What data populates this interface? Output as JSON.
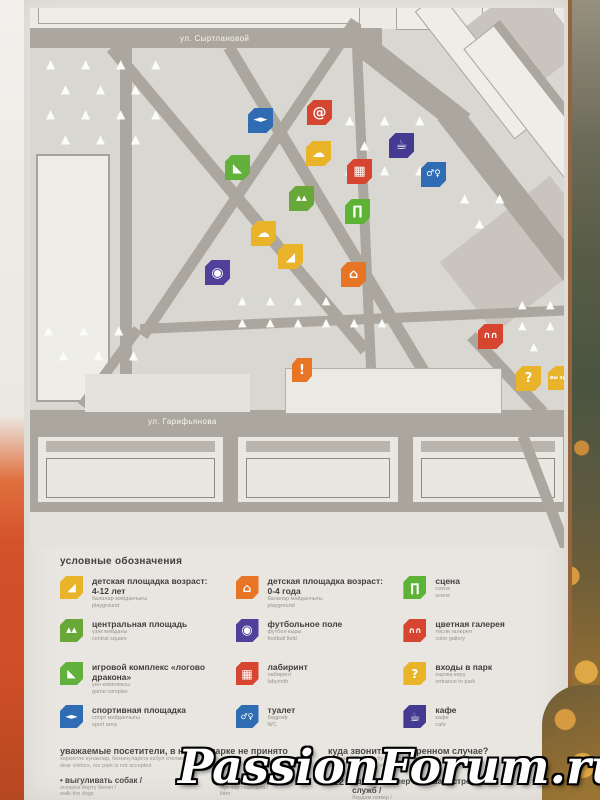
{
  "watermark": "PassionForum.ru",
  "map": {
    "street1": "ул. Сыртлановой",
    "street2": "ул. Гарифьянова",
    "icons": [
      {
        "name": "sport-area-icon",
        "glyph": "◄►",
        "color": "#2f6cb3",
        "x": 218,
        "y": 100,
        "fs": 9
      },
      {
        "name": "internet-point-icon",
        "glyph": "@",
        "color": "#d6452f",
        "x": 277,
        "y": 92,
        "fs": 14
      },
      {
        "name": "cafe-icon",
        "glyph": "☕",
        "color": "#453a92",
        "x": 359,
        "y": 125,
        "fs": 13
      },
      {
        "name": "art-object-icon",
        "glyph": "☁",
        "color": "#e9b32a",
        "x": 276,
        "y": 133,
        "fs": 13
      },
      {
        "name": "game-complex-icon",
        "glyph": "◣",
        "color": "#62b13c",
        "x": 195,
        "y": 147,
        "fs": 12
      },
      {
        "name": "labyrinth-icon",
        "glyph": "▦",
        "color": "#d6452f",
        "x": 317,
        "y": 151,
        "fs": 13
      },
      {
        "name": "wc-icon",
        "glyph": "♂♀",
        "color": "#2f6cb3",
        "x": 391,
        "y": 154,
        "fs": 9
      },
      {
        "name": "central-square-icon",
        "glyph": "▲▲",
        "color": "#68a839",
        "x": 259,
        "y": 178,
        "fs": 7
      },
      {
        "name": "scene-icon",
        "glyph": "∏",
        "color": "#5cb336",
        "x": 315,
        "y": 191,
        "fs": 13
      },
      {
        "name": "art-object-icon",
        "glyph": "☁",
        "color": "#e9b32a",
        "x": 221,
        "y": 213,
        "fs": 13
      },
      {
        "name": "playground-4-12-icon",
        "glyph": "◢",
        "color": "#e9b32a",
        "x": 248,
        "y": 236,
        "fs": 12
      },
      {
        "name": "football-field-icon",
        "glyph": "◉",
        "color": "#50409a",
        "x": 175,
        "y": 252,
        "fs": 14
      },
      {
        "name": "playground-0-4-icon",
        "glyph": "⌂",
        "color": "#e87425",
        "x": 311,
        "y": 254,
        "fs": 13
      },
      {
        "name": "color-gallery-icon",
        "glyph": "∩∩",
        "color": "#d6452f",
        "x": 448,
        "y": 316,
        "fs": 9
      },
      {
        "name": "attention-icon",
        "glyph": "!",
        "color": "#e87425",
        "x": 262,
        "y": 350,
        "fs": 13,
        "w": 20,
        "h": 24
      },
      {
        "name": "park-entrance-icon",
        "glyph": "?",
        "color": "#e9b32a",
        "x": 486,
        "y": 358,
        "fs": 13
      },
      {
        "name": "you-are-here-icon",
        "glyph": "вы здесь",
        "color": "#e9b32a",
        "x": 518,
        "y": 358,
        "fs": 5,
        "w": 30,
        "h": 24
      }
    ]
  },
  "legend": {
    "title": "условные обозначения",
    "columns": [
      [
        {
          "icon": "playground-4-12-icon",
          "glyph": "◢",
          "color": "#e9b32a",
          "fs": 11,
          "title": "детская площадка возраст: 4-12 лет",
          "sub1": "балалар мәйданчыгы",
          "sub2": "playground"
        },
        {
          "icon": "central-square-icon",
          "glyph": "▲▲",
          "color": "#68a839",
          "fs": 7,
          "title": "центральная площадь",
          "sub1": "үзәк мәйданы",
          "sub2": "central square"
        },
        {
          "icon": "game-complex-icon",
          "glyph": "◣",
          "color": "#62b13c",
          "fs": 11,
          "title": "игровой комплекс «логово дракона»",
          "sub1": "уен комплексы",
          "sub2": "game complex"
        },
        {
          "icon": "sport-area-icon",
          "glyph": "◄►",
          "color": "#2f6cb3",
          "fs": 8,
          "title": "спортивная площадка",
          "sub1": "спорт мәйданчыгы",
          "sub2": "sport area"
        }
      ],
      [
        {
          "icon": "playground-0-4-icon",
          "glyph": "⌂",
          "color": "#e87425",
          "fs": 12,
          "title": "детская площадка возраст: 0-4 года",
          "sub1": "балалар мәйданчыгы",
          "sub2": "playground"
        },
        {
          "icon": "football-field-icon",
          "glyph": "◉",
          "color": "#50409a",
          "fs": 13,
          "title": "футбольное поле",
          "sub1": "футбол кыры",
          "sub2": "football field"
        },
        {
          "icon": "labyrinth-icon",
          "glyph": "▦",
          "color": "#d6452f",
          "fs": 12,
          "title": "лабиринт",
          "sub1": "лабиринт",
          "sub2": "labyrinth"
        },
        {
          "icon": "wc-icon",
          "glyph": "♂♀",
          "color": "#2f6cb3",
          "fs": 8,
          "title": "туалет",
          "sub1": "бәдрәф",
          "sub2": "WC"
        }
      ],
      [
        {
          "icon": "scene-icon",
          "glyph": "∏",
          "color": "#5cb336",
          "fs": 12,
          "title": "сцена",
          "sub1": "сәхнә",
          "sub2": "scene"
        },
        {
          "icon": "color-gallery-icon",
          "glyph": "∩∩",
          "color": "#d6452f",
          "fs": 8,
          "title": "цветная галерея",
          "sub1": "төсле галерея",
          "sub2": "color gallery"
        },
        {
          "icon": "park-entrance-icon",
          "glyph": "?",
          "color": "#e9b32a",
          "fs": 12,
          "title": "входы в парк",
          "sub1": "паркка керү",
          "sub2": "entrance to park"
        },
        {
          "icon": "cafe-icon",
          "glyph": "☕",
          "color": "#453a92",
          "fs": 12,
          "title": "кафе",
          "sub1": "кафе",
          "sub2": "cafe"
        }
      ]
    ]
  },
  "notices": {
    "visitors": {
      "title": "уважаемые посетители, в нашем парке не принято",
      "sub1": "хөрмәтле кунаклар, безнең паркта кабул ителми /",
      "sub2": "dear visitors, our park is not accepted",
      "bullets_left": [
        {
          "text": "• выгуливать собак /",
          "s1": "этләрне йөртү белән /",
          "s2": "walk the dogs"
        },
        {
          "text": "• курить, распивать",
          "s1": "спиртные напитки /",
          "s2": "smoke"
        }
      ],
      "bullets_right": [
        {
          "text": "• мусорить /",
          "s1": "чүп-чар ташларга /",
          "s2": "litter"
        }
      ]
    },
    "emergency": {
      "title": "куда звонить в экстренном случае?",
      "sub1": "кая шалтыратырга бу очракта / экстренном /",
      "sub2": "where to call in case of emergency",
      "items": [
        {
          "number": "112",
          "text": "единый номер вызова экстренных служб /",
          "s1": "бердәм номер /",
          "s2": "single number for calling emergency services"
        }
      ]
    }
  }
}
